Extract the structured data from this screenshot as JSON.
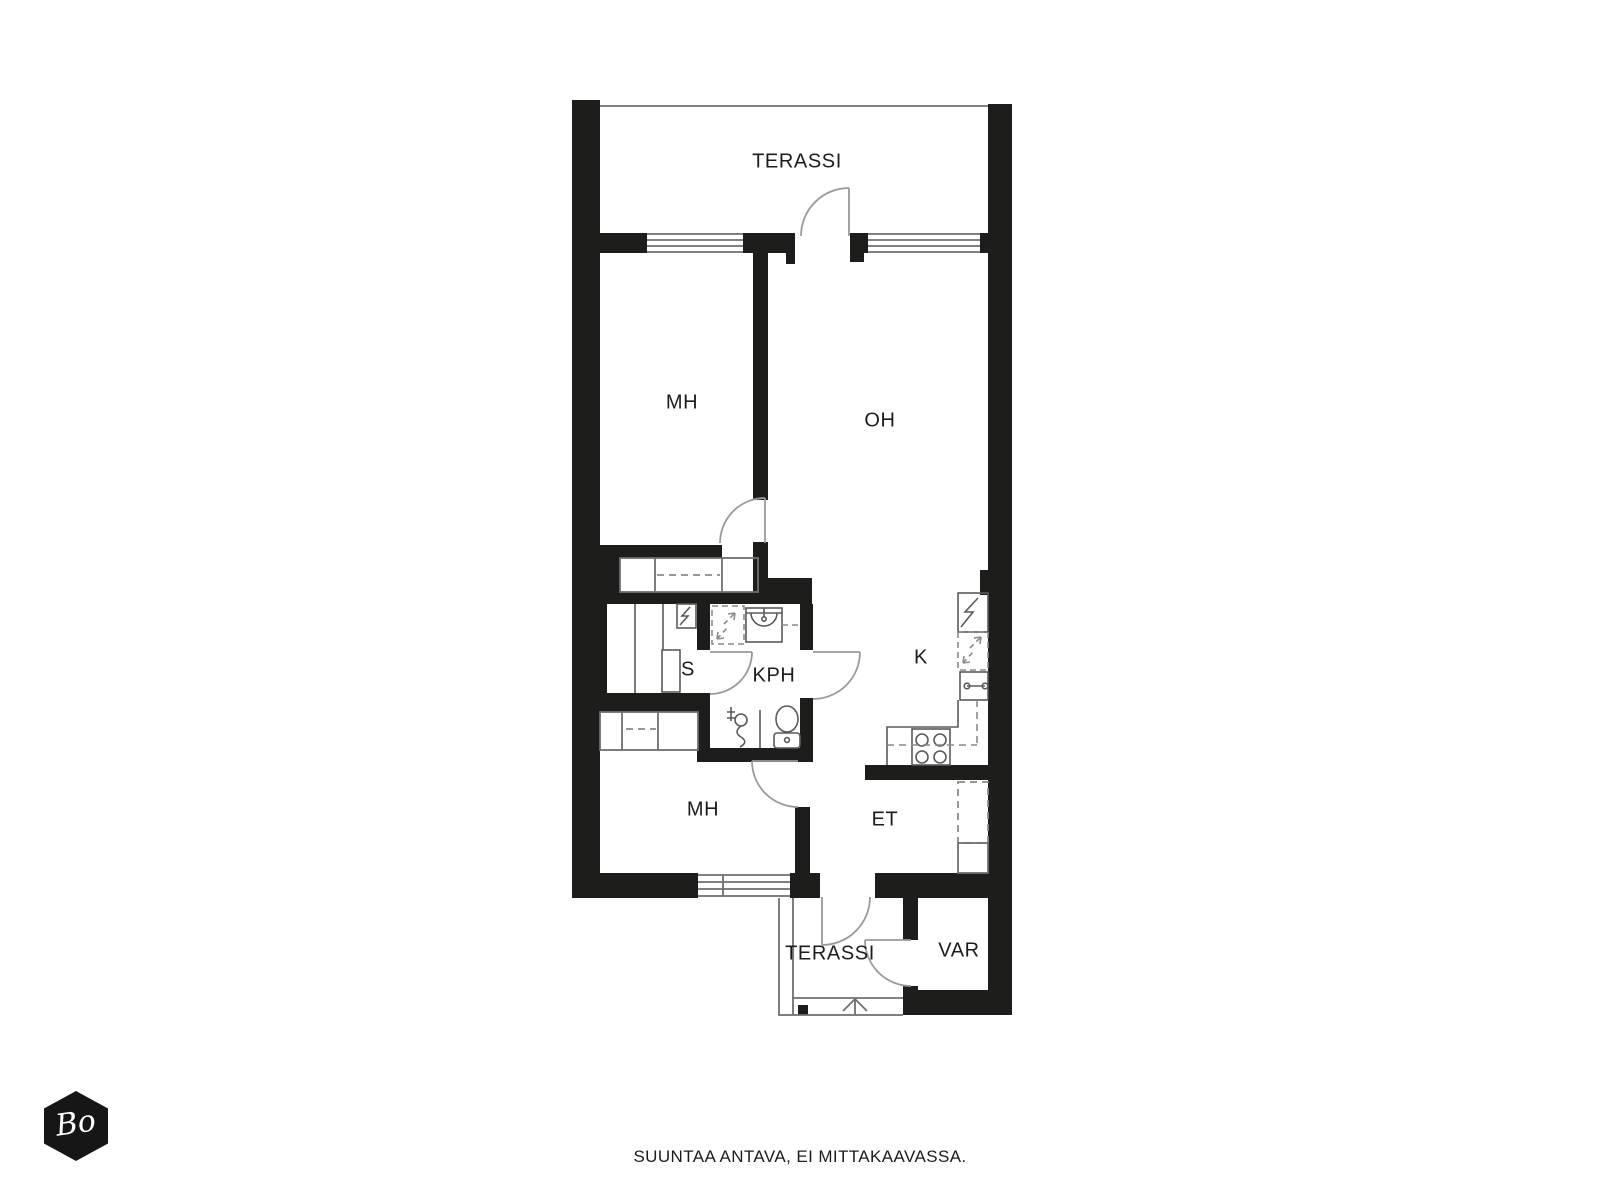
{
  "rooms": {
    "terassiTop": {
      "label": "TERASSI"
    },
    "mhTop": {
      "label": "MH"
    },
    "oh": {
      "label": "OH"
    },
    "sauna": {
      "label": "S"
    },
    "kph": {
      "label": "KPH"
    },
    "kitchen": {
      "label": "K"
    },
    "mhBottom": {
      "label": "MH"
    },
    "et": {
      "label": "ET"
    },
    "terassiBottom": {
      "label": "TERASSI"
    },
    "var": {
      "label": "VAR"
    }
  },
  "footer": {
    "disclaimer": "SUUNTAA ANTAVA, EI MITTAKAAVASSA."
  },
  "logo": {
    "text": "Bo"
  },
  "colors": {
    "wall": "#1d1d1b",
    "thin_line": "#6f6f6f",
    "door_arc": "#9a9a9a",
    "dashed_line": "#8a8a8a",
    "background": "#ffffff"
  },
  "icons": {
    "stairs_direction": "up-arrow",
    "sauna_heater": "lightning-box",
    "fridge": "lightning-box",
    "dishwasher": "dashed-lightning-box"
  }
}
